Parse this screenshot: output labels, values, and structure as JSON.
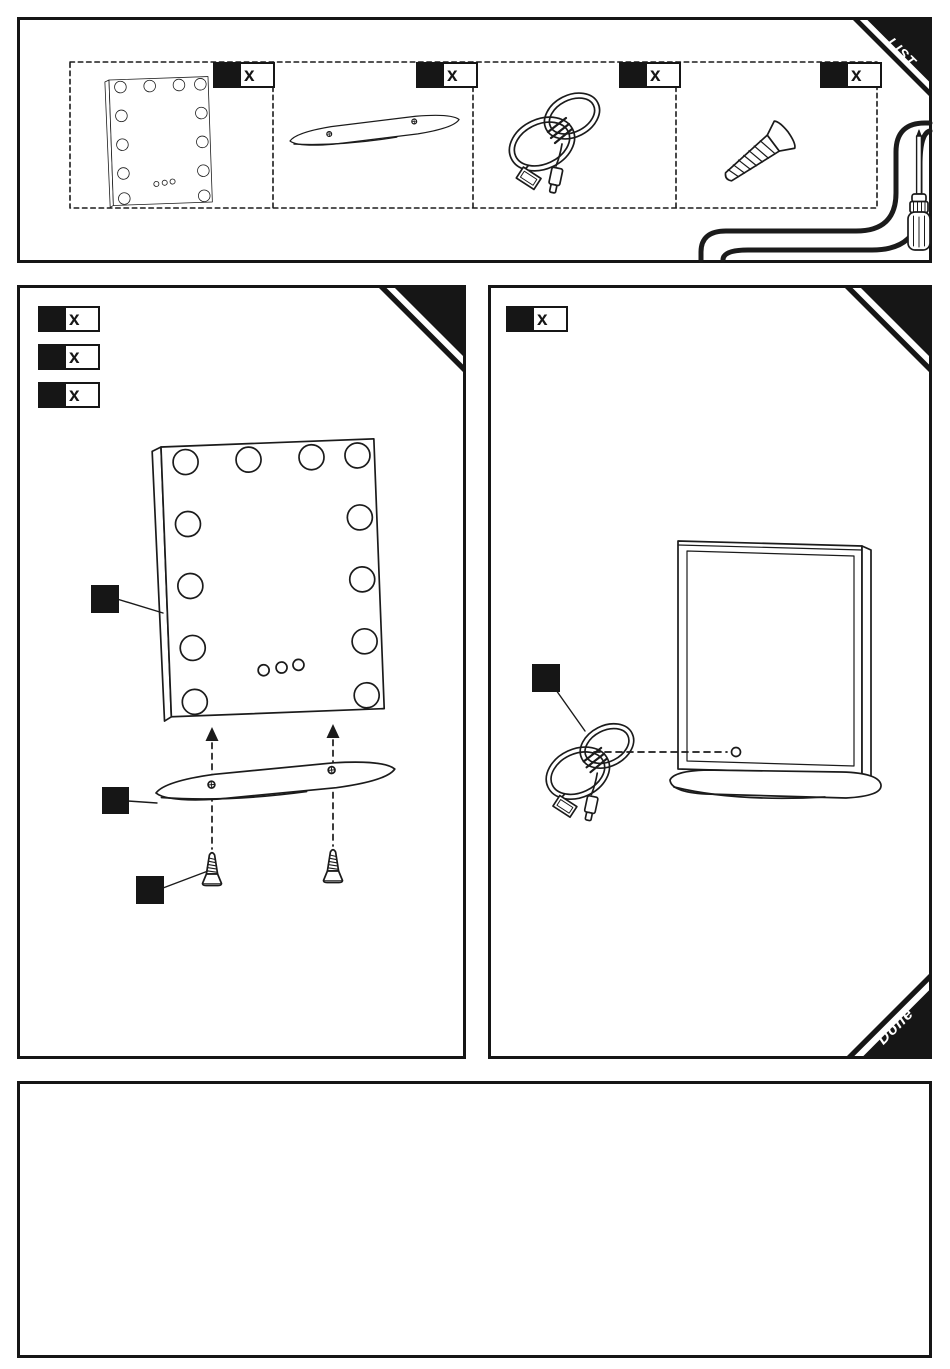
{
  "document": {
    "type": "assembly-instruction-sheet",
    "product": "lighted vanity mirror with base",
    "line_color": "#161616",
    "background": "#ffffff"
  },
  "list_panel": {
    "corner_tag": "LIST",
    "items": [
      {
        "part": "mirror-with-lights",
        "qty_label": "x"
      },
      {
        "part": "base-bar",
        "qty_label": "x"
      },
      {
        "part": "usb-cable",
        "qty_label": "x"
      },
      {
        "part": "screw",
        "qty_label": "x"
      }
    ],
    "tool": "screwdriver"
  },
  "step1_panel": {
    "part_labels": [
      {
        "qty_label": "x"
      },
      {
        "qty_label": "x"
      },
      {
        "qty_label": "x"
      }
    ],
    "callouts": [
      "mirror",
      "base-bar",
      "screw"
    ]
  },
  "step2_panel": {
    "part_labels": [
      {
        "qty_label": "x"
      }
    ],
    "corner_tag": "Done",
    "callouts": [
      "usb-cable"
    ]
  },
  "notes_panel": {
    "content": ""
  }
}
